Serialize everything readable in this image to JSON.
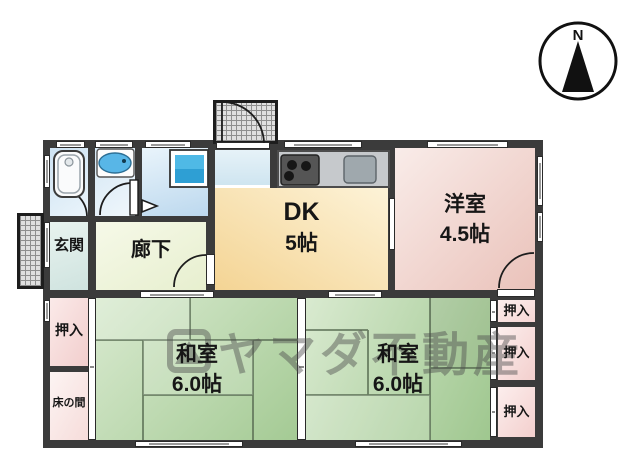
{
  "plan": {
    "compass": {
      "label": "N"
    },
    "watermark": {
      "text": "ヤマダ不動産"
    },
    "rooms": {
      "genkan": {
        "label": "玄関"
      },
      "rouka": {
        "label": "廊下"
      },
      "dk": {
        "label": "DK",
        "size": "5帖"
      },
      "youshitsu": {
        "label": "洋室",
        "size": "4.5帖"
      },
      "washitsu_left": {
        "label": "和室",
        "size": "6.0帖"
      },
      "washitsu_right": {
        "label": "和室",
        "size": "6.0帖"
      },
      "oshiire_left": {
        "label": "押入"
      },
      "tokonoma": {
        "label": "床の間"
      },
      "oshiire_right_top": {
        "label": "押入"
      },
      "oshiire_right_mid": {
        "label": "押入"
      },
      "oshiire_right_bottom": {
        "label": "押入"
      }
    },
    "fixtures": [
      "bathtub",
      "washbasin",
      "washing-machine",
      "gas-stove",
      "kitchen-sink"
    ],
    "colors": {
      "wall": "#3b3b3b",
      "tatami_green": "#aed09e",
      "dk_yellow": "#f5d694",
      "youshitsu_pink": "#eac2ba",
      "closet_pink": "#f4d3d1",
      "water_blue": "#cde2f2",
      "hallway_green": "#eef3d9",
      "genkan_green": "#d9eae4"
    }
  }
}
